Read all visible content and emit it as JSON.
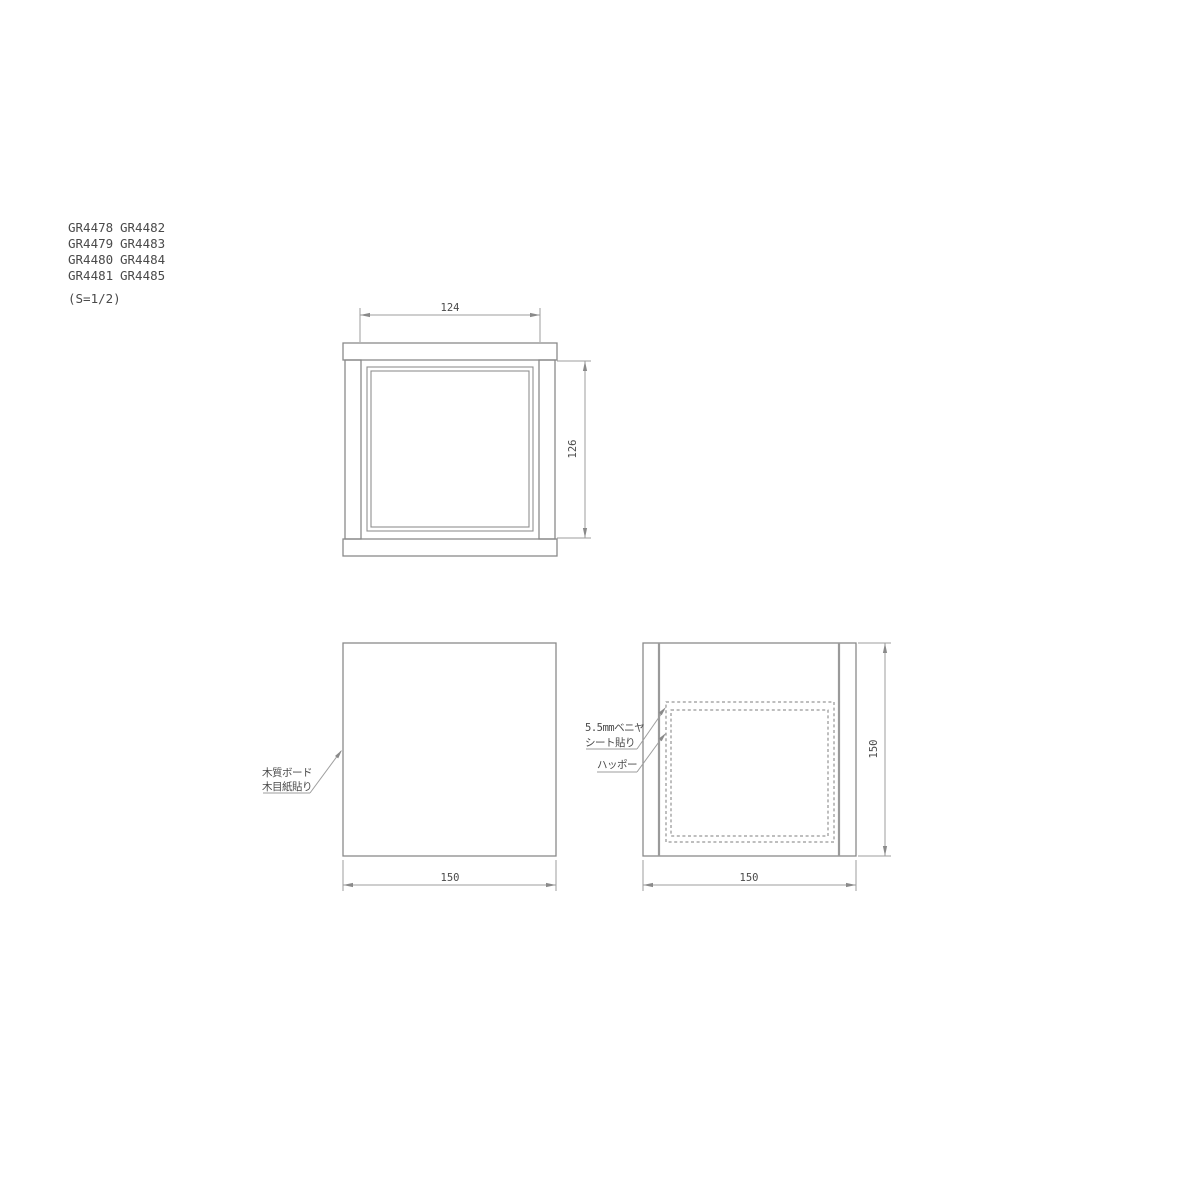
{
  "part_list": {
    "ids": [
      "GR4478",
      "GR4482",
      "GR4479",
      "GR4483",
      "GR4480",
      "GR4484",
      "GR4481",
      "GR4485"
    ],
    "scale_note": "(S=1/2)"
  },
  "front_view": {
    "width_dim": "124",
    "height_dim": "126"
  },
  "plan_view": {
    "width_dim": "150",
    "material_label_line1": "木質ボード",
    "material_label_line2": "木目紙貼り"
  },
  "section_view": {
    "width_dim": "150",
    "height_dim": "150",
    "plywood_label_line1": "5.5mmベニヤ",
    "plywood_label_line2": "シート貼り",
    "foam_label": "ハッポー"
  }
}
